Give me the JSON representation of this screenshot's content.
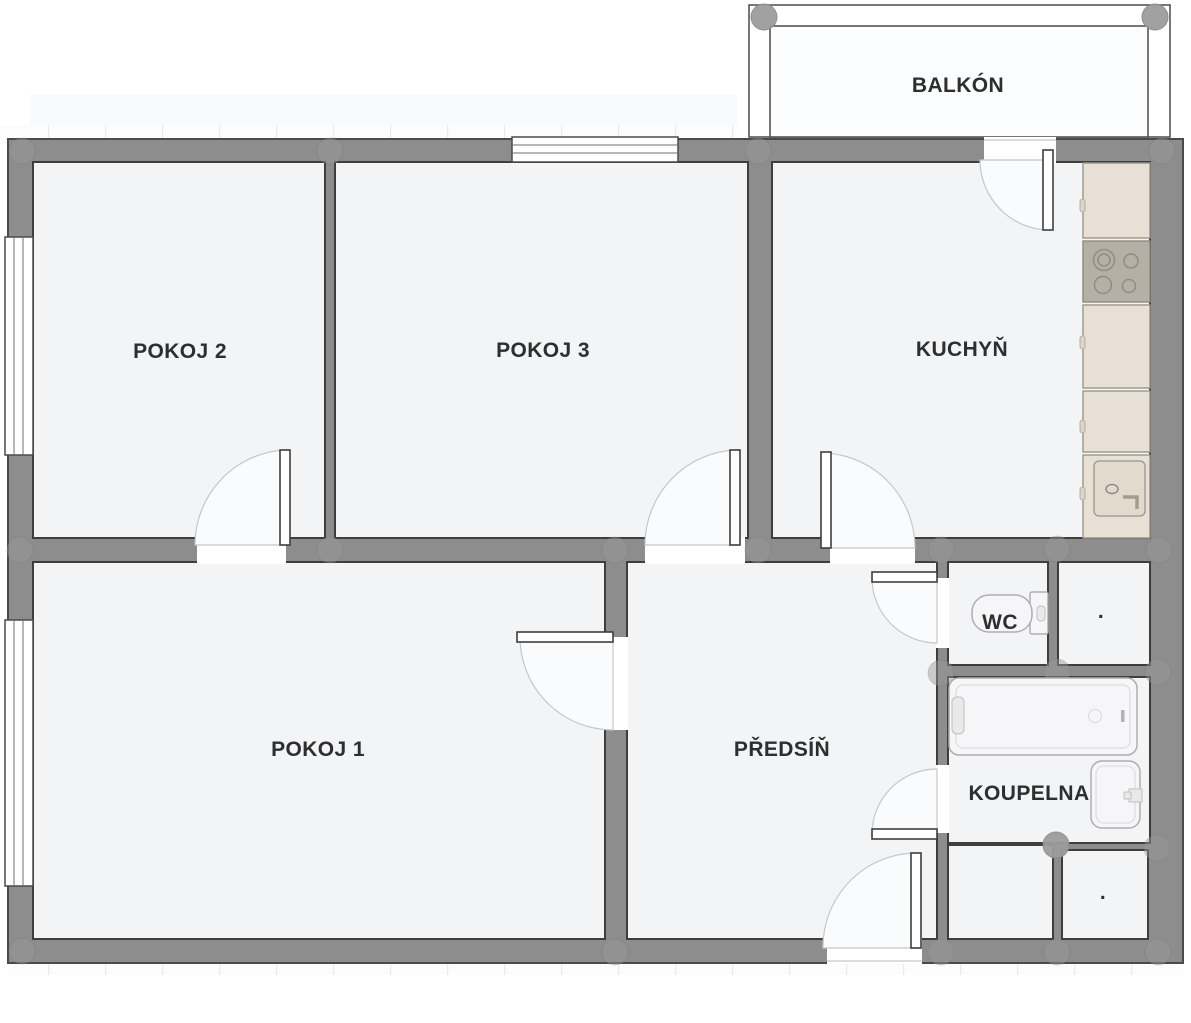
{
  "palette": {
    "wall": "#8d8d8d",
    "wall_edge": "#4a4a4a",
    "room_edge": "#3e3e3e",
    "floor": "#f3f4f6",
    "balcony_floor": "#fbfcfd",
    "swing": "#fafbfd",
    "arc": "#c7c7c7",
    "counter": "#e8e0d5",
    "stove": "#b6afa6",
    "label": "#2e2e2e"
  },
  "rooms": {
    "balkon": {
      "label": "BALKÓN"
    },
    "pokoj2": {
      "label": "POKOJ 2"
    },
    "pokoj3": {
      "label": "POKOJ 3"
    },
    "kuchyn": {
      "label": "KUCHYŇ"
    },
    "pokoj1": {
      "label": "POKOJ 1"
    },
    "predsin": {
      "label": "PŘEDSÍŇ"
    },
    "wc": {
      "label": "WC"
    },
    "koupelna": {
      "label": "KOUPELNA"
    },
    "storage_top": {
      "label": "."
    },
    "storage_bottom": {
      "label": "."
    }
  },
  "fixtures": {
    "bathtub": "bathtub",
    "washbasin": "washbasin",
    "toilet": "toilet",
    "kitchen_counter": "kitchen-counter",
    "stove": "cooktop-4-burners",
    "kitchen_sink": "kitchen-sink"
  }
}
